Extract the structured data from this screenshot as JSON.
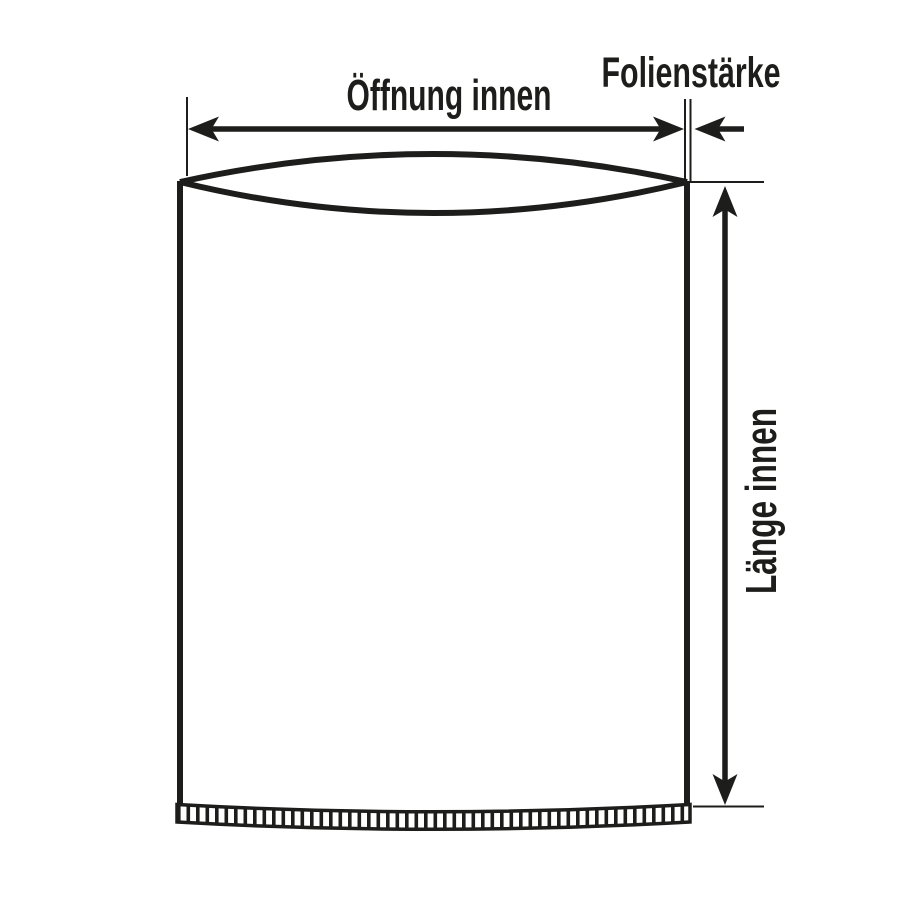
{
  "figure": {
    "type": "technical-dimension-diagram",
    "subject": "flat plastic bag with bottom seal seam",
    "background_color": "#ffffff",
    "line_color": "#1d1d1b",
    "labels": {
      "opening_width": "Öffnung innen",
      "film_thickness": "Folienstärke",
      "inner_length": "Länge innen"
    }
  }
}
